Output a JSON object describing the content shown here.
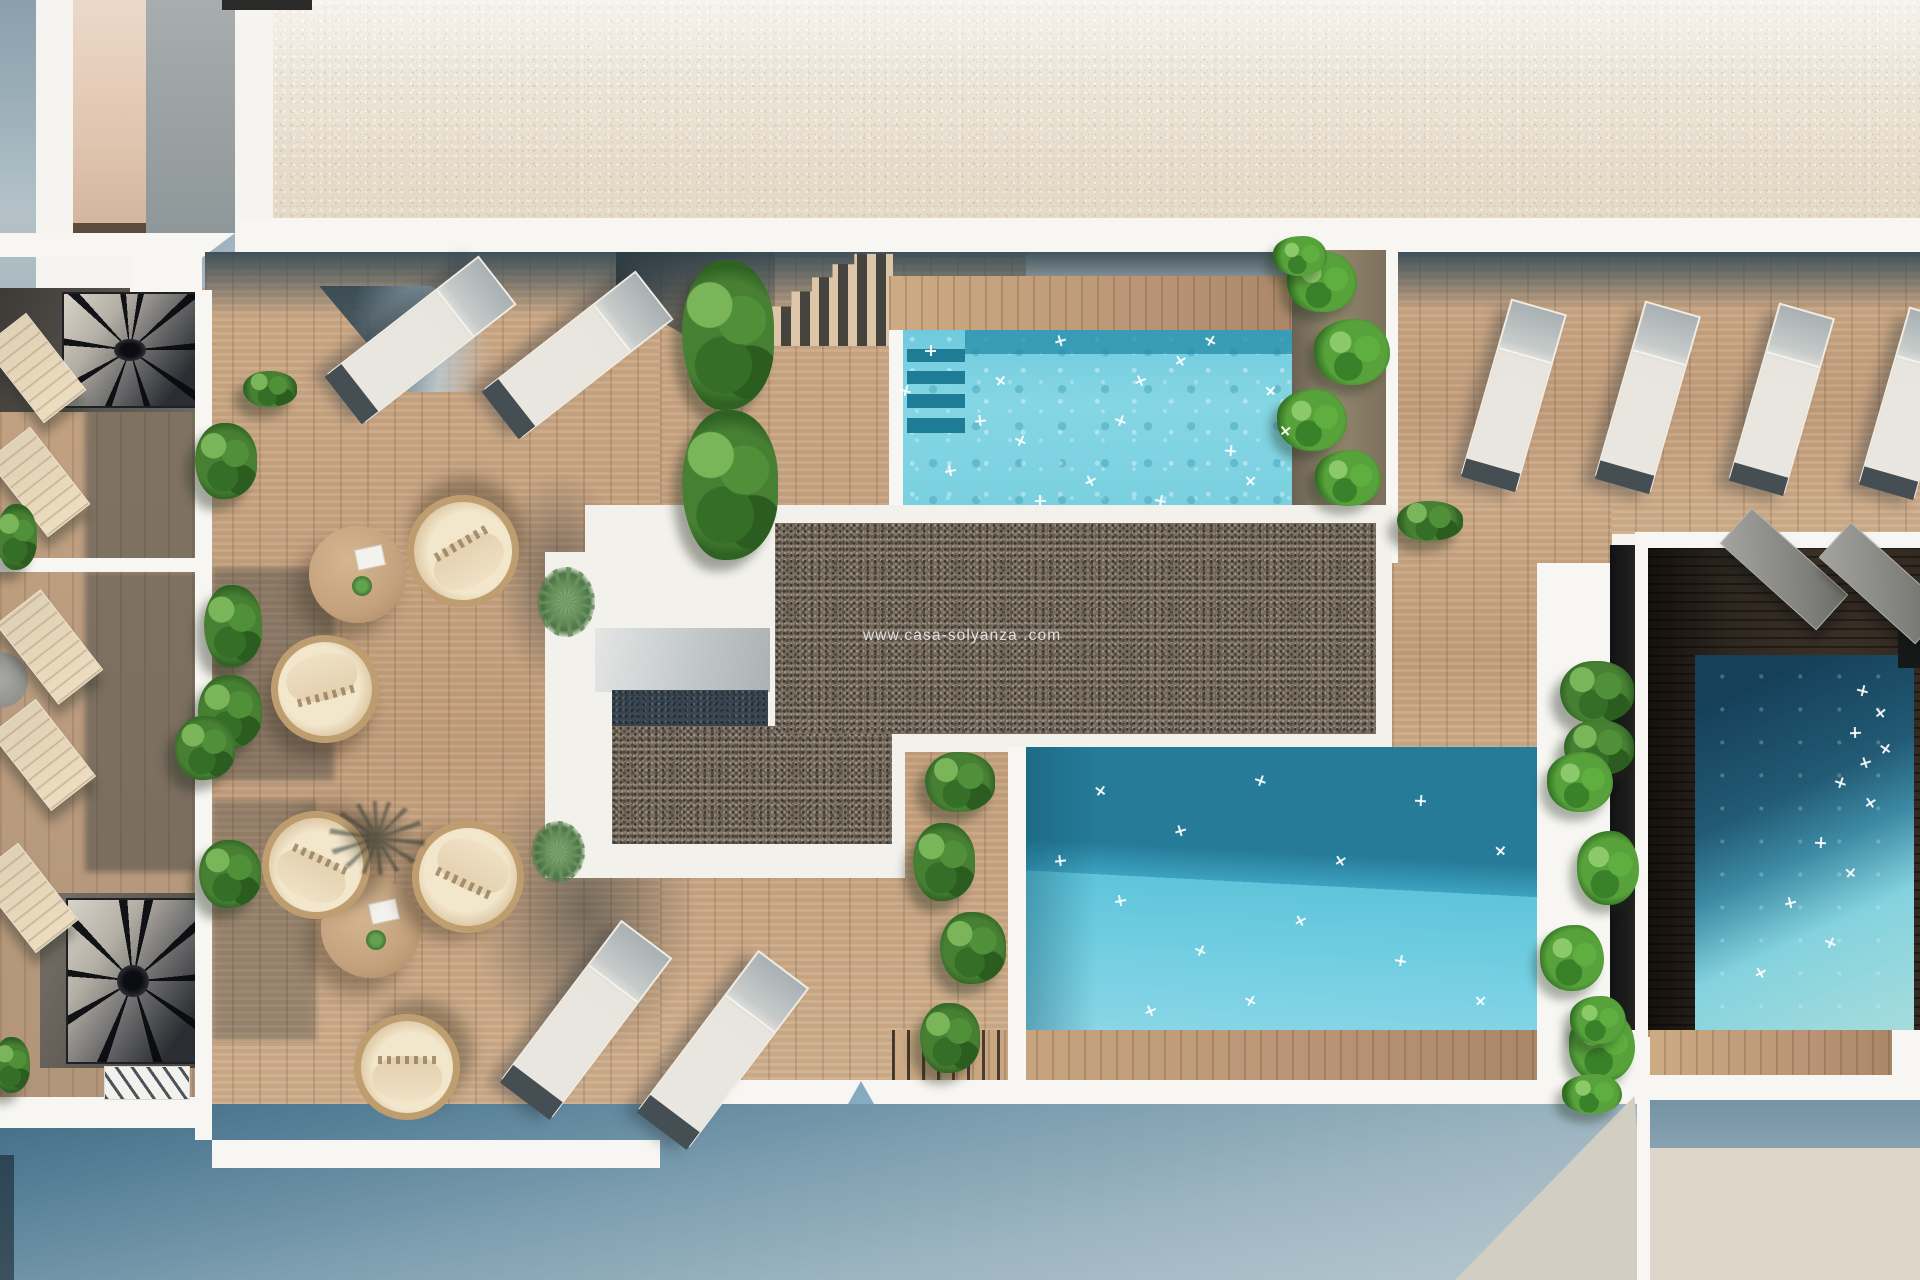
{
  "scene": {
    "title": "rooftop-terrace-aerial-render",
    "watermark": "www.casa-solyanza .com",
    "palette": {
      "white_wall": "#f6f4f0",
      "deck_wood": "#c7a582",
      "dark_terrace_wood": "#2b241e",
      "plaza_stone": "#e7dfcf",
      "gravel_roof": "#756b5e",
      "pool_turquoise": "#7fd2e1",
      "pool_blue": "#4fb6d2",
      "pool_deep_blue": "#16405a",
      "shadow_blue": "#5d859c",
      "foliage_green": "#477f33",
      "cushion_cream": "#ead9bd"
    },
    "objects": {
      "pools": 3,
      "sun_loungers": 15,
      "rattan_chairs": 5,
      "round_tables": 2,
      "spiral_staircases": 2,
      "plants_and_bushes": 27
    }
  }
}
